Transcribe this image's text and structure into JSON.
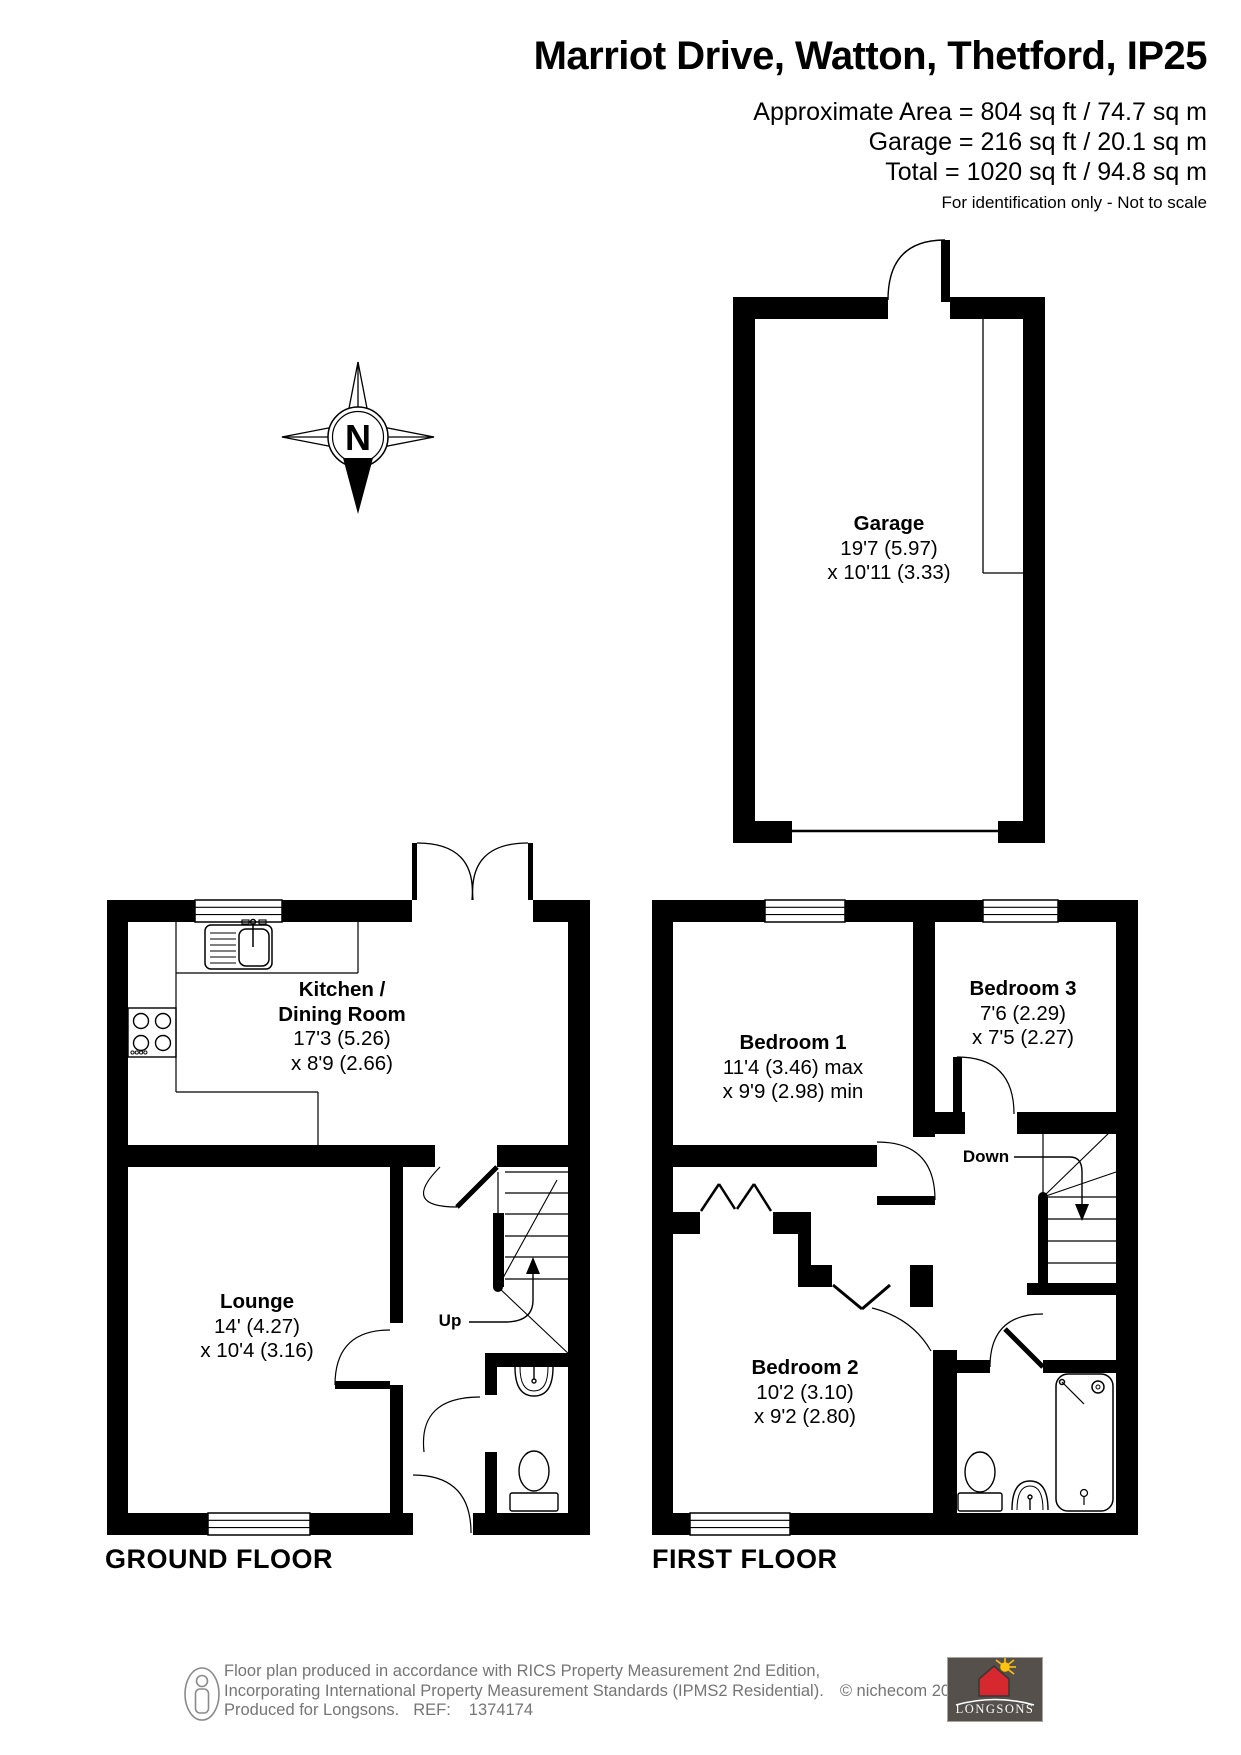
{
  "header": {
    "title": "Marriot Drive, Watton, Thetford, IP25",
    "area_lines": [
      "Approximate Area = 804 sq ft / 74.7 sq m",
      "Garage = 216 sq ft / 20.1 sq m",
      "Total = 1020 sq ft / 94.8 sq m"
    ],
    "disclaimer": "For identification only - Not to scale"
  },
  "compass": {
    "north": "N"
  },
  "rooms": {
    "garage": {
      "name": "Garage",
      "dims": [
        "19'7 (5.97)",
        "x 10'11 (3.33)"
      ]
    },
    "kitchen": {
      "name_line1": "Kitchen /",
      "name_line2": "Dining Room",
      "dims": [
        "17'3 (5.26)",
        "x 8'9 (2.66)"
      ]
    },
    "lounge": {
      "name": "Lounge",
      "dims": [
        "14' (4.27)",
        "x 10'4 (3.16)"
      ]
    },
    "bedroom1": {
      "name": "Bedroom 1",
      "dims": [
        "11'4 (3.46) max",
        "x 9'9 (2.98) min"
      ]
    },
    "bedroom2": {
      "name": "Bedroom 2",
      "dims": [
        "10'2 (3.10)",
        "x 9'2 (2.80)"
      ]
    },
    "bedroom3": {
      "name": "Bedroom 3",
      "dims": [
        "7'6 (2.29)",
        "x 7'5 (2.27)"
      ]
    }
  },
  "stairs": {
    "up": "Up",
    "down": "Down"
  },
  "floor_labels": {
    "ground": "GROUND FLOOR",
    "first": "FIRST FLOOR"
  },
  "footer": {
    "line1": "Floor plan produced in accordance with RICS Property Measurement 2nd Edition,",
    "line2": "Incorporating International Property Measurement Standards (IPMS2 Residential).",
    "copyright": "© nichecom 2024.",
    "line3": "Produced for Longsons.",
    "ref_label": "REF:",
    "ref_value": "1374174"
  },
  "logo": {
    "text": "LONGSONS"
  },
  "colors": {
    "wall": "#000000",
    "footer_text": "#757575",
    "logo_bg": "#55504b",
    "logo_house": "#d7282f",
    "logo_sun": "#ffc20e"
  }
}
